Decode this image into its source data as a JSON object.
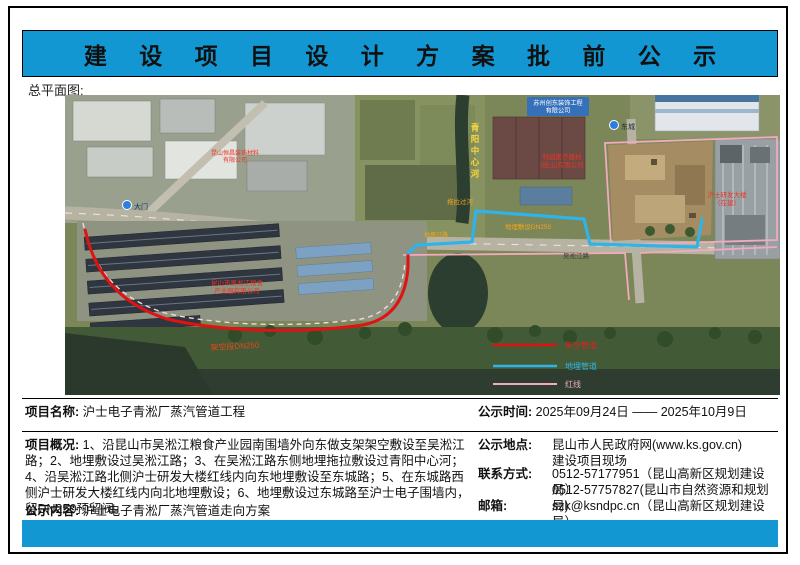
{
  "banner": {
    "title": "建 设 项 目 设 计 方 案 批 前 公 示",
    "color": "#1397d2"
  },
  "plan_label": "总平面图:",
  "map": {
    "company_top": {
      "line1": "苏州创东装饰工程",
      "line2": "有限公司"
    },
    "river_name": "青阳中心河",
    "company_keyuan": {
      "line1": "科园医疗器材",
      "line2": "(昆山)有限公司"
    },
    "company_grain": {
      "line1": "昆山市吴淞江粮食",
      "line2": "产业园有限公司"
    },
    "company_decor": {
      "line1": "昆山恒昌装饰材料",
      "line2": "有限公司"
    },
    "rd_building": {
      "line1": "沪士研发大楼",
      "line2": "（在建）"
    },
    "marker_dongcheng": "东城",
    "marker_gate": "大门",
    "pipe_aerial": "架空段DN250",
    "pipe_buried": "地埋敷设DN250",
    "pipe_cross_river": "拖拉过河",
    "pipe_cross_road": "地埋过路",
    "road_wusongjiang": "吴淞江路",
    "legend": {
      "aerial": "架空管道",
      "buried": "地埋管道",
      "redline": "红线"
    },
    "colors": {
      "aerial": "#e01212",
      "buried": "#2eb3ea",
      "redline": "#f2aabc"
    }
  },
  "info": {
    "project_name": {
      "label": "项目名称:",
      "value": "沪士电子青淞厂蒸汽管道工程"
    },
    "overview": {
      "label": "项目概况:",
      "value": "1、沿昆山市吴淞江粮食产业园南围墙外向东做支架架空敷设至吴淞江路；2、地埋敷设过吴淞江路；3、在吴淞江路东侧地埋拖拉敷设过青阳中心河；4、沿吴淞江路北侧沪士研发大楼红线内向东地埋敷设至东城路；5、在东城路西侧沪士研发大楼红线内向北地埋敷设；6、地埋敷设过东城路至沪士电子围墙内，留DN250预留阀。"
    },
    "content": {
      "label": "公示内容:",
      "value": "沪士电子青淞厂蒸汽管道走向方案"
    },
    "time": {
      "label": "公示时间:",
      "value": "2025年09月24日 —— 2025年10月9日"
    },
    "place": {
      "label": "公示地点:",
      "line1": "昆山市人民政府网(www.ks.gov.cn)",
      "line2": "建设项目现场"
    },
    "contact": {
      "label": "联系方式:",
      "line1": "0512-57177951（昆山高新区规划建设局）",
      "line2": "0512-57757827(昆山市自然资源和规划局)"
    },
    "email": {
      "label": "邮箱:",
      "value": "szk@ksndpc.cn（昆山高新区规划建设局）"
    }
  }
}
